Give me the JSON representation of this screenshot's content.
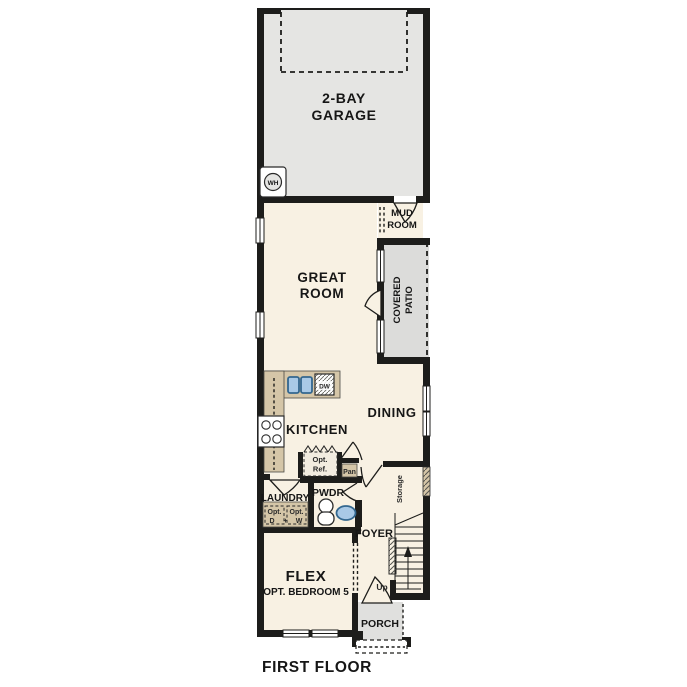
{
  "page": {
    "plan_title": "FIRST FLOOR"
  },
  "colors": {
    "wall": "#1d1d1b",
    "interior_floor": "#f8f1e3",
    "garage_floor": "#e5e5e3",
    "patio_floor": "#dcdcda",
    "porch_floor": "#e0e0de",
    "counter_tan": "#d5c6a8",
    "sink_blue": "#a9c9e6",
    "label_text": "#161616"
  },
  "rooms": {
    "garage": {
      "line1": "2-BAY",
      "line2": "GARAGE"
    },
    "mud_room": {
      "line1": "MUD",
      "line2": "ROOM"
    },
    "great_room": {
      "line1": "GREAT",
      "line2": "ROOM"
    },
    "covered_patio": {
      "line1": "COVERED",
      "line2": "PATIO"
    },
    "kitchen": {
      "label": "KITCHEN"
    },
    "dining": {
      "label": "DINING"
    },
    "laundry": {
      "label": "LAUNDRY",
      "opt1_line1": "Opt.",
      "opt1_line2": "D",
      "plus": "+",
      "opt2_line1": "Opt.",
      "opt2_line2": "W"
    },
    "powder": {
      "label": "PWDR"
    },
    "foyer": {
      "label": "FOYER"
    },
    "storage": {
      "label": "Storage"
    },
    "stairs": {
      "up": "Up"
    },
    "flex": {
      "line1": "FLEX",
      "line2": "OPT. BEDROOM 5"
    },
    "porch": {
      "label": "PORCH"
    }
  },
  "fixtures": {
    "water_heater": "WH",
    "dishwasher": "DW",
    "opt_fridge_line1": "Opt.",
    "opt_fridge_line2": "Ref.",
    "pantry": "Pan"
  }
}
